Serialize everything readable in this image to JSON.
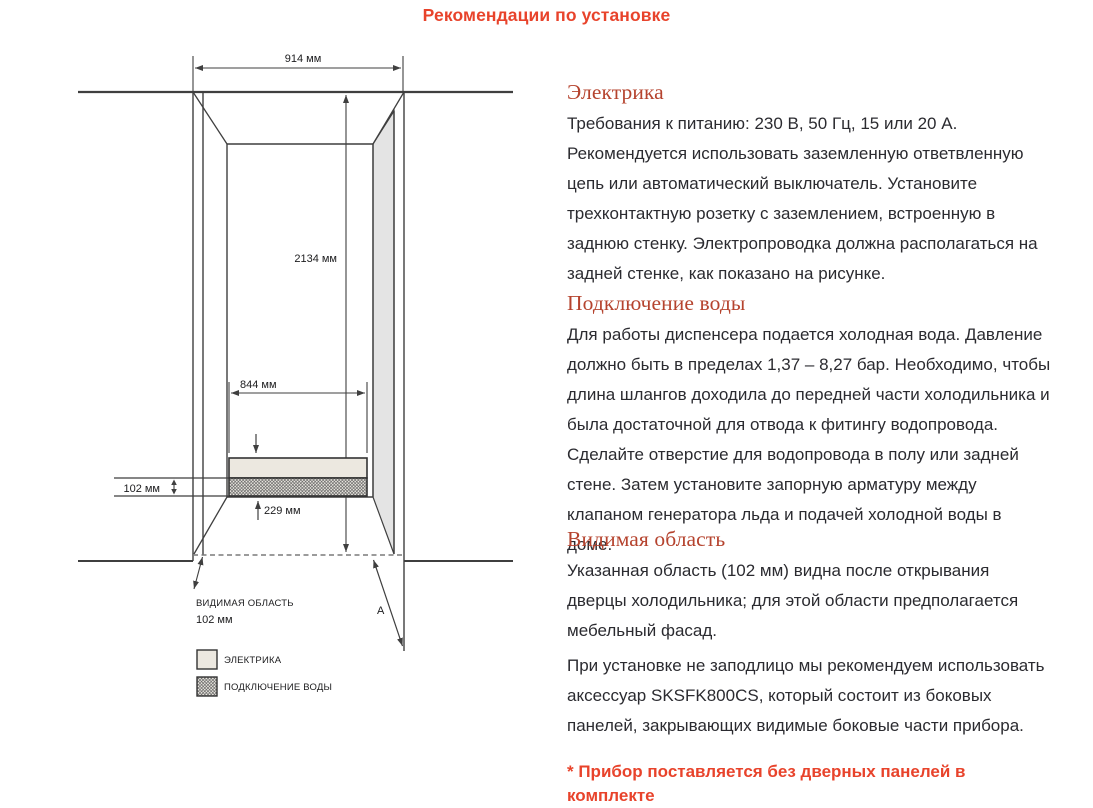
{
  "page": {
    "title": "Рекомендации по установке"
  },
  "diagram": {
    "labels": {
      "niche_width": "914 мм",
      "niche_height": "2134 мм",
      "inner_width": "844 мм",
      "visible_depth": "102 мм",
      "bottom_offset": "229 мм",
      "visible_area_line1": "ВИДИМАЯ ОБЛАСТЬ",
      "visible_area_line2": "102 мм",
      "door_dimension": "A"
    },
    "legend": {
      "electrical": "ЭЛЕКТРИКА",
      "water": "ПОДКЛЮЧЕНИЕ ВОДЫ"
    },
    "colors": {
      "electrical_zone_fill": "#ece8e0",
      "side_panel_fill": "#e4e4e4",
      "line": "#3f3f3f"
    }
  },
  "sections": {
    "electrical": {
      "heading": "Электрика",
      "body": "Требования к питанию: 230 В, 50 Гц, 15 или 20 А. Рекомендуется использовать заземленную ответвленную цепь или автоматический выключатель. Установите трехконтактную розетку с заземлением, встроенную в заднюю стенку. Электропроводка должна располагаться на задней стенке, как показано на рисунке."
    },
    "water": {
      "heading": "Подключение воды",
      "body": "Для работы диспенсера подается холодная вода. Давление должно быть в пределах 1,37 – 8,27 бар. Необходимо, чтобы длина шлангов доходила до передней части холодильника и была достаточной для отвода к фитингу водопровода. Сделайте отверстие для водопровода в полу или задней стене. Затем установите запорную арматуру между клапаном генератора льда и подачей холодной воды в доме."
    },
    "visible_area": {
      "heading": "Видимая область",
      "body": "Указанная область (102 мм) видна после открывания дверцы холодильника; для этой области предполагается мебельный фасад."
    },
    "note": "При установке не заподлицо мы рекомендуем использовать аксессуар SKSFK800CS, который состоит из боковых панелей, закрывающих видимые боковые части прибора.",
    "footnote": "* Прибор поставляется без дверных панелей в комплекте"
  },
  "colors": {
    "title_accent": "#e8432b",
    "section_heading": "#b5432e",
    "body_text": "#2b2b30"
  }
}
